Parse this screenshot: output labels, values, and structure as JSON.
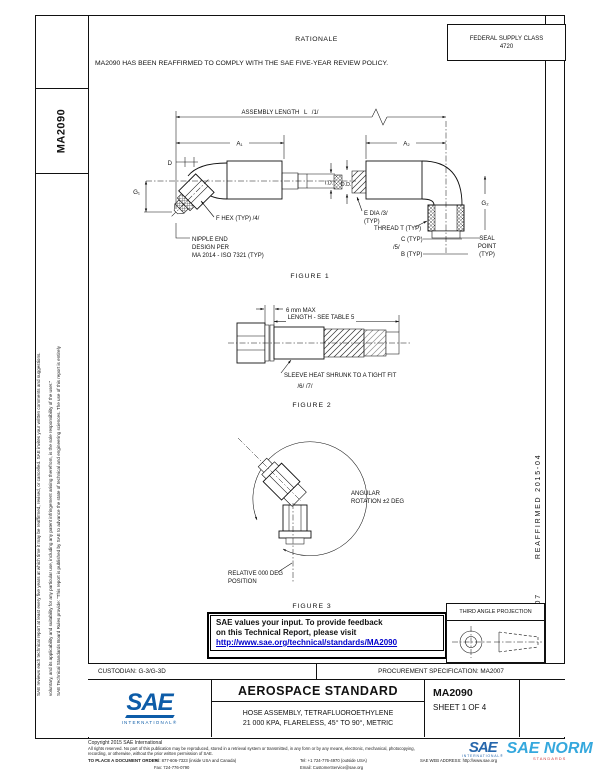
{
  "fsc": {
    "line1": "FEDERAL SUPPLY CLASS",
    "line2": "4720"
  },
  "rationale": {
    "title": "RATIONALE",
    "body": "MA2090 HAS BEEN REAFFIRMED TO COMPLY WITH THE SAE FIVE-YEAR REVIEW POLICY."
  },
  "left_margin": {
    "doc_number": "MA2090",
    "disclaimer1a": "SAE Technical Standards Board Rules provide: “This report is published by SAE to advance the state of technical and engineering sciences. The use of this report is entirely",
    "disclaimer1b": "voluntary, and its applicability and suitability for any particular use, including any patent infringement arising therefrom, is the sole responsibility of the user.”",
    "disclaimer2": "SAE reviews each technical report at least every five years at which time it may be reaffirmed, revised, or cancelled. SAE invites your written comments and suggestions."
  },
  "right_margin": {
    "issued": "ISSUED 1995-07",
    "reaffirmed": "REAFFIRMED 2015-04"
  },
  "figure1": {
    "caption": "FIGURE 1",
    "assembly_length": "ASSEMBLY LENGTH  L  /1/",
    "a1": "A₁",
    "a2": "A₂",
    "d": "D",
    "g1": "G₁",
    "g2": "G₂",
    "f_hex": "F HEX (TYP) /4/",
    "nipple_1": "NIPPLE END",
    "nipple_2": "DESIGN PER",
    "nipple_3": "MA 2014 - ISO 7321 (TYP)",
    "id": "I.D.",
    "od": "O.D.",
    "e_dia_1": "E DIA /3/",
    "e_dia_2": "(TYP)",
    "thread": "THREAD T (TYP)",
    "c": "C (TYP)",
    "note5": "/5/",
    "b": "B (TYP)",
    "seal_1": "SEAL",
    "seal_2": "POINT",
    "seal_3": "(TYP)"
  },
  "figure2": {
    "caption": "FIGURE 2",
    "max_label": "6 mm MAX",
    "length_label": "LENGTH - SEE TABLE 5",
    "sleeve_label": "SLEEVE HEAT SHRUNK TO A TIGHT FIT",
    "notes": "/6/ /7/"
  },
  "figure3": {
    "caption": "FIGURE 3",
    "angular_1": "ANGULAR",
    "angular_2": "ROTATION ±2 DEG",
    "relative_1": "RELATIVE 000 DEG",
    "relative_2": "POSITION"
  },
  "feedback": {
    "line1": "SAE values your input. To provide feedback",
    "line2": "on this Technical Report, please visit",
    "link": "http://www.sae.org/technical/standards/MA2090"
  },
  "projection": {
    "title": "THIRD ANGLE PROJECTION"
  },
  "title_block": {
    "custodian": "CUSTODIAN: G-3/G-3D",
    "procurement": "PROCUREMENT SPECIFICATION: MA2007",
    "logo_sae": "SAE",
    "logo_sub": "INTERNATIONAL®",
    "standard_type": "AEROSPACE STANDARD",
    "title_line1": "HOSE ASSEMBLY, TETRAFLUOROETHYLENE",
    "title_line2": "21 000 KPA, FLARELESS, 45° TO 90°, METRIC",
    "doc_number": "MA2090",
    "sheet": "SHEET 1 OF 4"
  },
  "footer": {
    "copyright": "Copyright 2015 SAE International",
    "rights1": "All rights reserved. No part of this publication may be reproduced, stored in a retrieval system or transmitted, in any form or by any means, electronic, mechanical, photocopying,",
    "rights2": "recording, or otherwise, without the prior written permission of SAE.",
    "order_label": "TO PLACE A DOCUMENT ORDER:",
    "tel1": "Tel: 877-606-7323 (inside USA and Canada)",
    "fax": "Fax: 724-776-0790",
    "tel2": "Tel: +1 724-776-4970 (outside USA)",
    "email": "Email: CustomerService@sae.org",
    "web": "SAE WEB ADDRESS: http://www.sae.org"
  },
  "watermark": {
    "logo_sae": "SAE",
    "logo_sub": "INTERNATIONAL®",
    "norm": "SAE NORM",
    "tagline": "STANDARDS"
  },
  "colors": {
    "sae_blue": "#0d5ca8",
    "link_blue": "#0000cc",
    "watermark_blue": "#2ba4dc",
    "tagline_red": "#cc3333"
  }
}
